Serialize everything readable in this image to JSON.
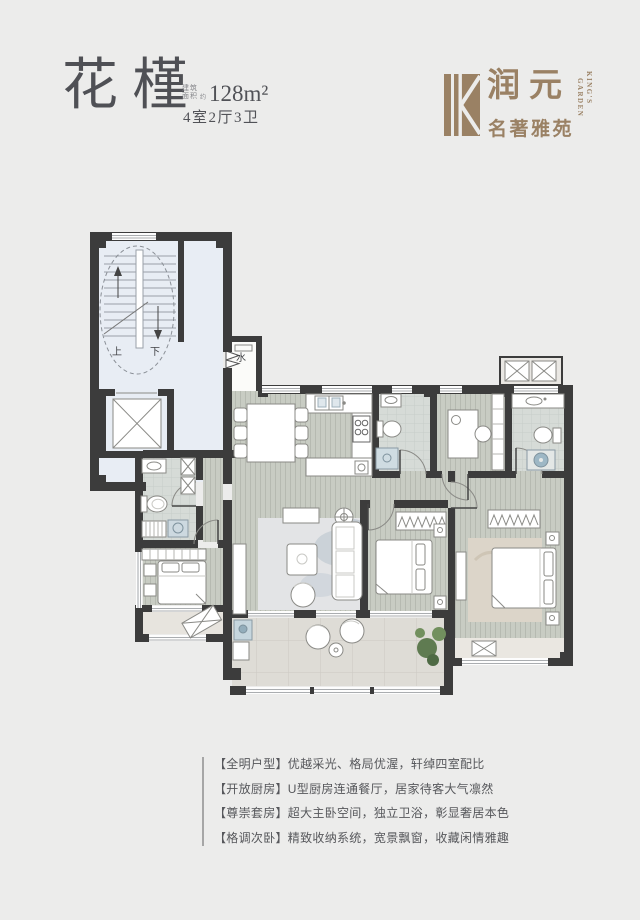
{
  "header": {
    "plan_name": "花槿",
    "area_label_line1": "建筑",
    "area_label_line2": "面积",
    "area_approx": "约",
    "area_value": "128m²",
    "layout_spec": "4室2厅3卫"
  },
  "logo": {
    "brand": "润元",
    "sub_brand": "名著雅苑",
    "english_line1": "KING'S",
    "english_line2": "GARDEN",
    "brand_color": "#9a8164"
  },
  "floor_plan": {
    "label_up": "上",
    "label_down": "下",
    "label_water": "水",
    "wall_color": "#3c3c3c",
    "stair_floor_color": "#e8edf4",
    "wood_floor_color": "#c8ccc3"
  },
  "features": {
    "items": [
      "【全明户型】优越采光、格局优渥，轩绰四室配比",
      "【开放厨房】U型厨房连通餐厅，居家待客大气凛然",
      "【尊崇套房】超大主卧空间，独立卫浴，彰显奢居本色",
      "【格调次卧】精致收纳系统，宽景飘窗，收藏闲情雅趣"
    ]
  }
}
